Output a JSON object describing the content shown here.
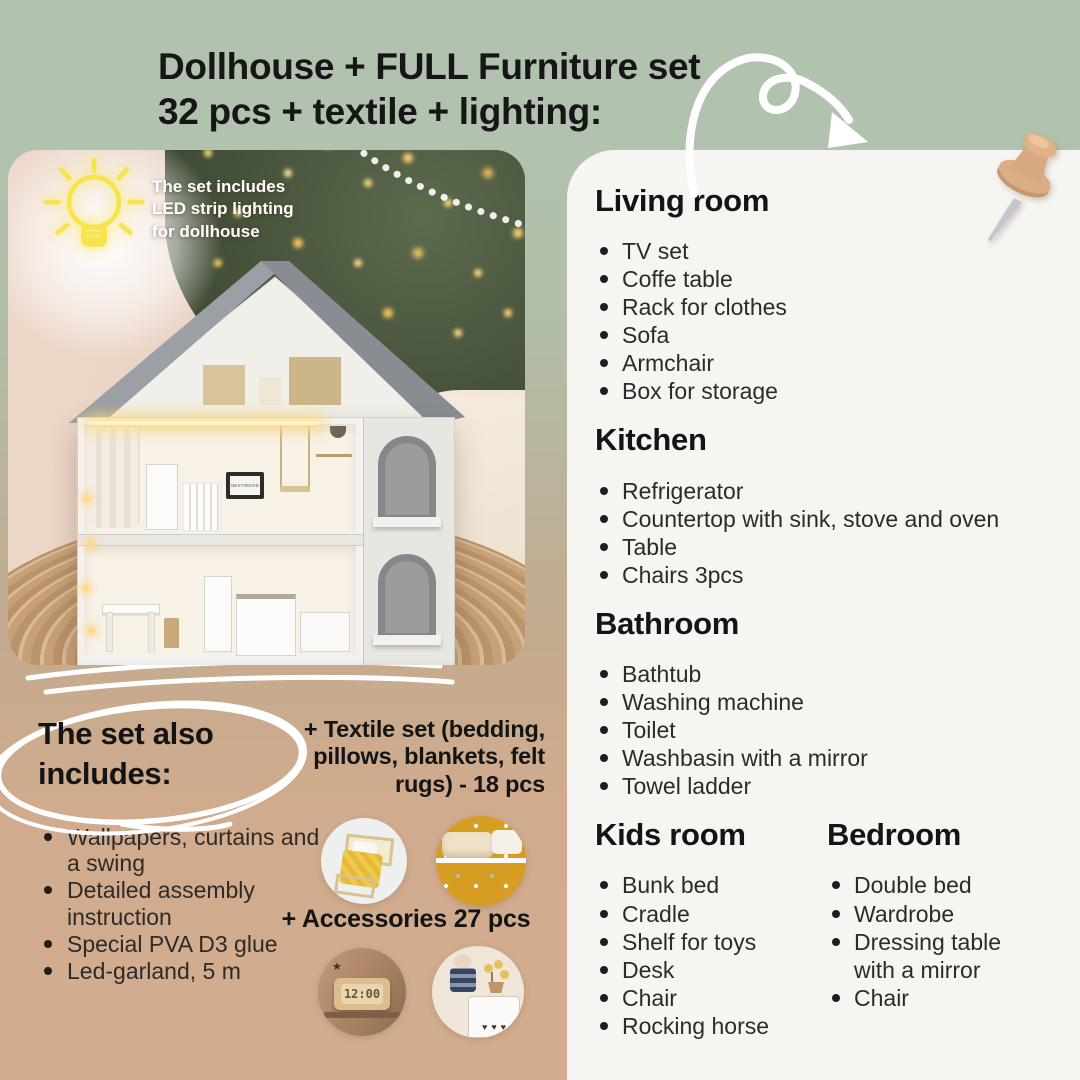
{
  "header": {
    "title": "Dollhouse + FULL Furniture set\n32 pcs + textile + lighting:"
  },
  "photo": {
    "badge": "The set includes\nLED strip lighting\nfor dollhouse",
    "tv_label": "NESTWOOD"
  },
  "rooms": [
    {
      "title": "Living room",
      "items": [
        "TV set",
        "Coffe table",
        "Rack for clothes",
        "Sofa",
        "Armchair",
        "Box for storage"
      ]
    },
    {
      "title": "Kitchen",
      "items": [
        "Refrigerator",
        "Countertop with sink, stove and oven",
        "Table",
        "Chairs 3pcs"
      ]
    },
    {
      "title": "Bathroom",
      "items": [
        "Bathtub",
        "Washing machine",
        "Toilet",
        "Washbasin with a mirror",
        "Towel ladder"
      ]
    },
    {
      "title": "Kids room",
      "items": [
        "Bunk bed",
        "Cradle",
        "Shelf for toys",
        "Desk",
        "Chair",
        "Rocking horse"
      ]
    },
    {
      "title": "Bedroom",
      "items": [
        "Double bed",
        "Wardrobe",
        "Dressing table with a mirror",
        "Chair"
      ]
    }
  ],
  "also_includes": {
    "title": "The set also includes:",
    "items": [
      "Wallpapers, curtains and a swing",
      "Detailed assembly instruction",
      "Special PVA D3 glue",
      "Led-garland, 5 m"
    ]
  },
  "extras": {
    "textile_label": "+ Textile set (bedding,\npillows, blankets, felt\nrugs) - 18 pcs",
    "accessories_label": "+ Accessories 27 pcs",
    "clock_time": "12:00"
  },
  "colors": {
    "header_green": "#b2c3af",
    "panel_cream": "#f7f5f1",
    "bottom_tan": "#d2ac8e",
    "neon_yellow": "#f7e44c",
    "pin_tan": "#d8a981",
    "doodle_white": "#ffffff",
    "text_ink": "#161616"
  }
}
